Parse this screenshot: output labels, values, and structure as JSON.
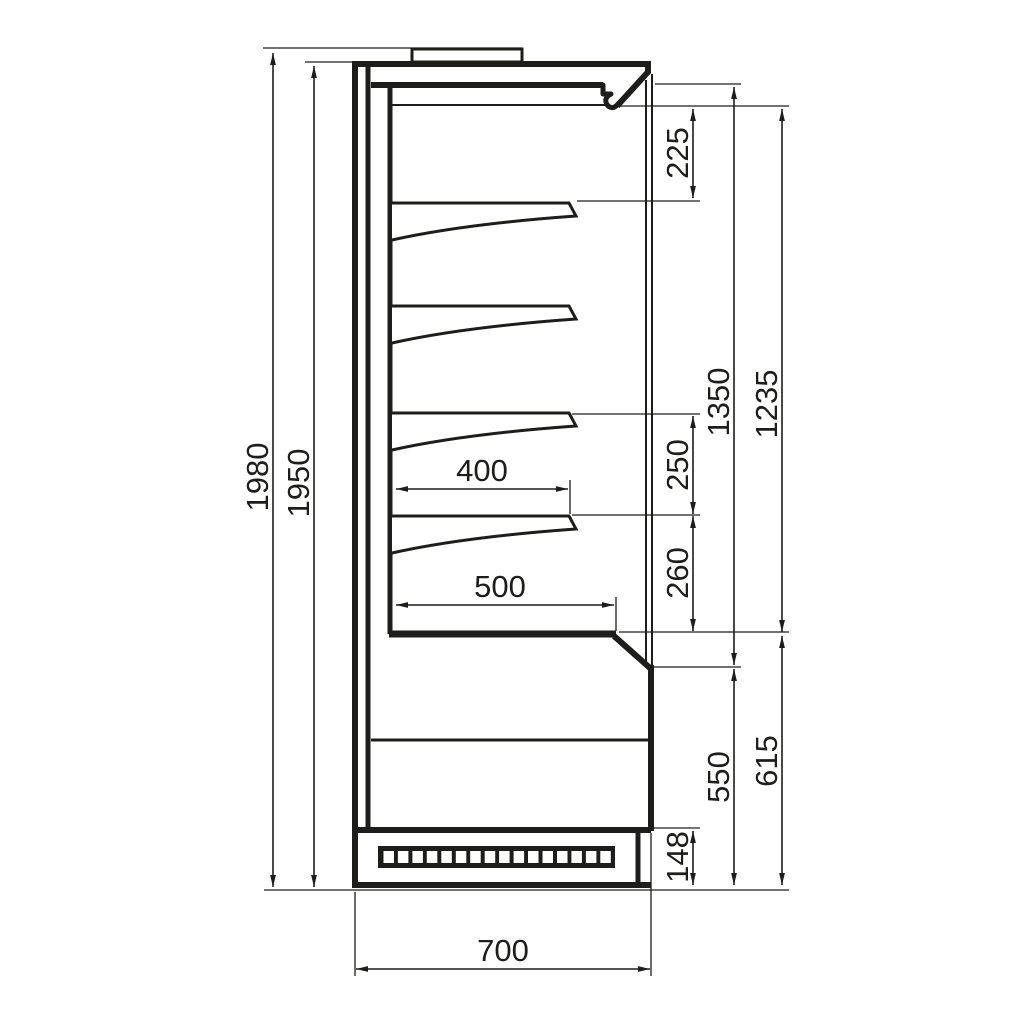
{
  "drawing": {
    "background": "#ffffff",
    "line_color": "#1d1d1b",
    "labels": {
      "overall_height": "1980",
      "cabinet_height": "1950",
      "top_clearance": "225",
      "shelf_gap_upper": "250",
      "shelf_gap_lower": "260",
      "inner_height_front": "1350",
      "opening_height": "1235",
      "base_height_outer": "615",
      "base_height_inner": "550",
      "plinth_height": "148",
      "shelf_depth": "400",
      "deck_depth": "500",
      "overall_depth": "700"
    }
  }
}
